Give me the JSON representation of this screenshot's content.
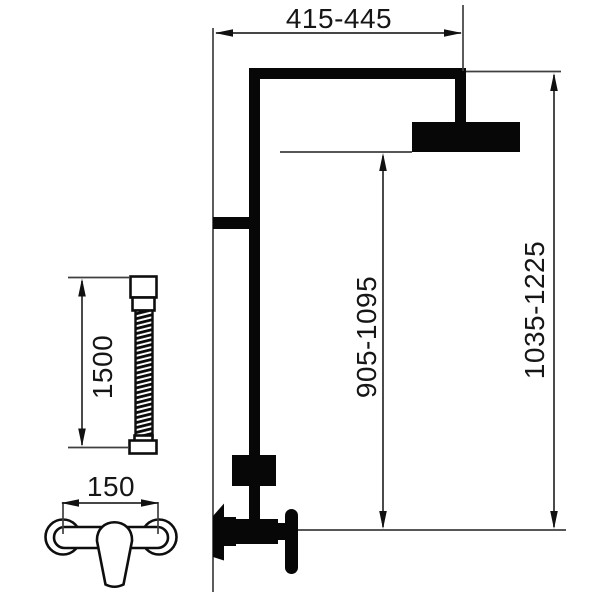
{
  "labels": {
    "top_width": "415-445",
    "overall_height": "1035-1225",
    "head_to_valve": "905-1095",
    "hose_length": "1500",
    "valve_spacing": "150"
  },
  "colors": {
    "ink": "#111111",
    "thin_line": "#3f3f3f",
    "background": "#ffffff"
  }
}
